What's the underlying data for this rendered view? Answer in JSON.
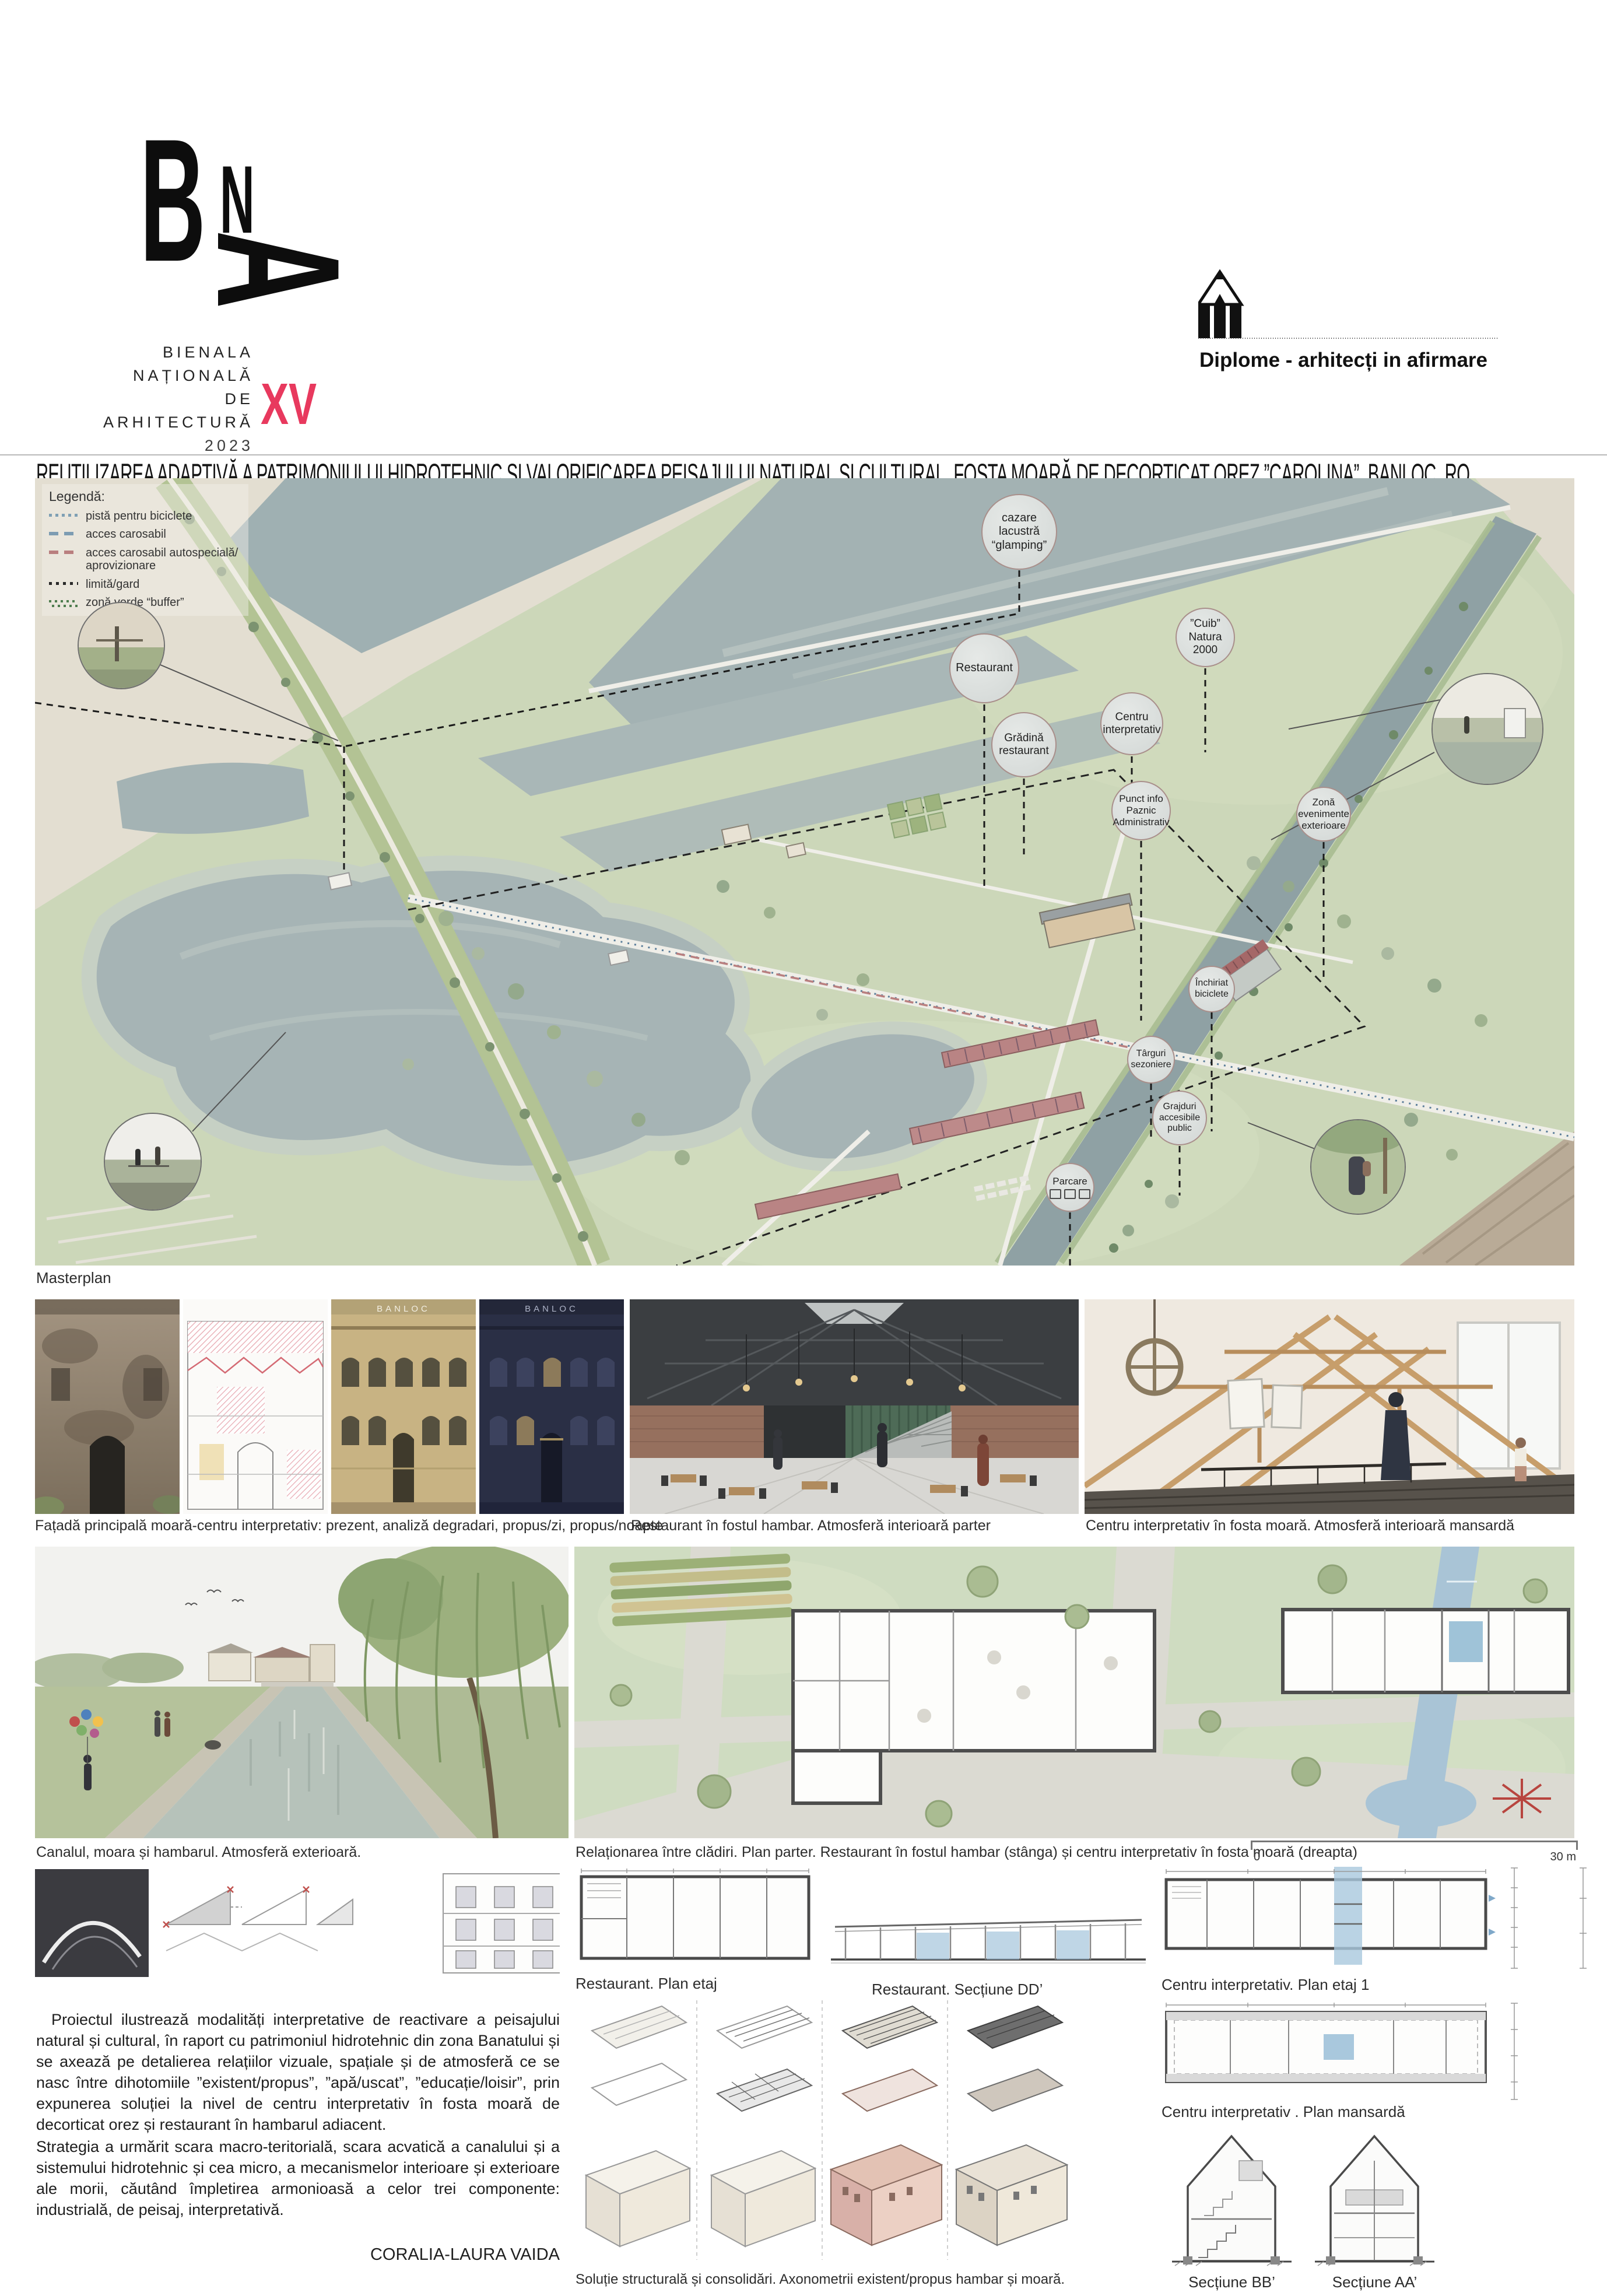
{
  "colors": {
    "accent_pink": "#e8395e",
    "label_circle_border": "#a98f8b",
    "water": "#a7b5b6",
    "canal": "#8fa1a4",
    "grass": "#ccd7b9",
    "beige": "#e3ded1",
    "drawing_blue": "#a9c8dd"
  },
  "header": {
    "logo": {
      "b": "B",
      "n": "N",
      "a": "A",
      "lines": [
        "BIENALA",
        "NAȚIONALĂ",
        "DE",
        "ARHITECTURĂ"
      ],
      "year": "2023",
      "edition": "XV"
    },
    "program": "Diplome - arhitecți in afirmare"
  },
  "title": "REUTILIZAREA ADAPTIVĂ A PATRIMONIULUI HIDROTEHNIC ȘI VALORIFICAREA PEISAJULUI NATURAL ȘI CULTURAL, FOSTA MOARĂ DE DECORTICAT OREZ ”CAROLINA”, BANLOC, RO",
  "masterplan": {
    "caption": "Masterplan",
    "legend": {
      "title": "Legendă:",
      "items": [
        {
          "label": "pistă pentru biciclete",
          "swatch": "dotted-blue"
        },
        {
          "label": "acces carosabil",
          "swatch": "dashed-blue"
        },
        {
          "label": "acces carosabil autospecială/ aprovizionare",
          "swatch": "dashed-red"
        },
        {
          "label": "limită/gard",
          "swatch": "dotted-black"
        },
        {
          "label": "zonă verde “buffer”",
          "swatch": "dotted-green"
        }
      ]
    },
    "labels": [
      {
        "text": "cazare lacustră “glamping”"
      },
      {
        "text": "Restaurant"
      },
      {
        "text": "Grădină restaurant"
      },
      {
        "text": "Centru interpretativ"
      },
      {
        "text": "”Cuib” Natura 2000"
      },
      {
        "text": "Punct info Paznic Administrativ"
      },
      {
        "text": "Zonă evenimente exterioare"
      },
      {
        "text": "Închiriat biciclete"
      },
      {
        "text": "Târguri sezoniere"
      },
      {
        "text": "Grajduri accesibile public"
      },
      {
        "text": "Parcare"
      }
    ]
  },
  "row2": {
    "facade_caption": "Fațadă principală moară-centru interpretativ: prezent, analiză degradari, propus/zi, propus/noapte",
    "facade_sign": "BANLOC",
    "restaurant_caption": "Restaurant în fostul hambar. Atmosferă interioară parter",
    "attic_caption": "Centru interpretativ în fosta moară. Atmosferă interioară mansardă"
  },
  "row3": {
    "canal_caption": "Canalul, moara și hambarul. Atmosferă exterioară.",
    "siteplan_caption": "Relaționarea între clădiri. Plan parter. Restaurant în fostul hambar (stânga) și centru interpretativ în fosta moară (dreapta)",
    "scale": {
      "start": "0",
      "end": "30 m"
    }
  },
  "drawings": {
    "restaurant_plan": "Restaurant. Plan etaj",
    "restaurant_section": "Restaurant. Secțiune DD’",
    "ci_plan1": "Centru interpretativ. Plan etaj 1",
    "ci_mansarda": "Centru interpretativ . Plan mansardă",
    "section_bb": "Secțiune BB’",
    "section_aa": "Secțiune AA’",
    "axo_caption": "Soluție structurală și consolidări. Axonometrii existent/propus hambar și moară."
  },
  "description": {
    "p1": "Proiectul ilustrează modalități interpretative de reactivare a peisajului natural și cultural, în raport cu patrimoniul hidrotehnic din zona Banatului și se axează pe detalierea relațiilor vizuale, spațiale și de atmosferă ce se nasc între dihotomiile ”existent/propus”, ”apă/uscat”, ”educație/loisir”, prin expunerea soluției la nivel de centru interpretativ în fosta moară de decorticat orez și restaurant în hambarul adiacent.",
    "p2": "Strategia a urmărit scara macro-teritorială, scara acvatică a canalului și a sistemului hidrotehnic și cea micro, a mecanismelor interioare și exterioare ale morii, căutând împletirea armonioasă a celor trei componente: industrială, de peisaj, interpretativă.",
    "author": "CORALIA-LAURA VAIDA"
  }
}
